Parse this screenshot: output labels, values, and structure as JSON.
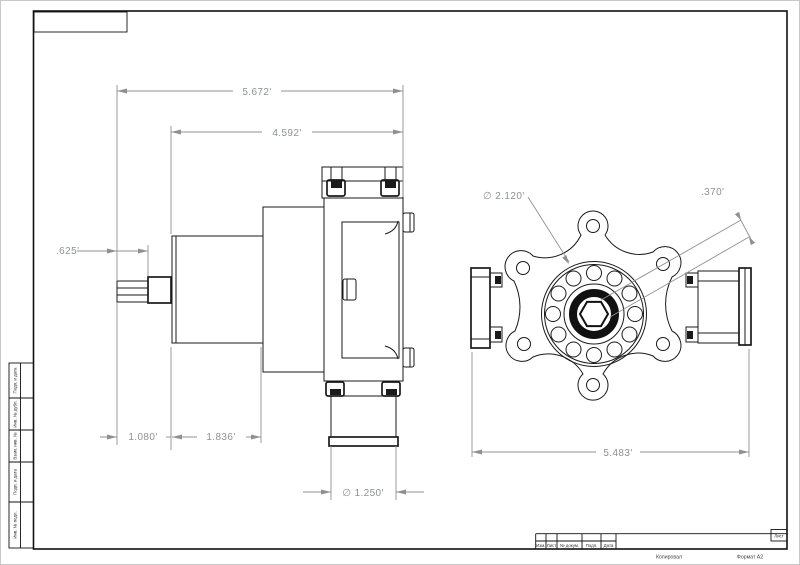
{
  "title_block": {
    "revision_headers": [
      "Изм.",
      "Лист",
      "№ докум.",
      "Подп.",
      "Дата"
    ],
    "sheet_label": "Лист",
    "copied_label": "Копировал",
    "format_label": "Формат А2"
  },
  "margin_labels": [
    "Подп. и дата",
    "Инв. № дубл.",
    "Взам. инв. №",
    "Подп. и дата",
    "Инв. № подл."
  ],
  "side_view": {
    "dim_overall": "5.672'",
    "dim_body": "4.592'",
    "dim_shaft": ".625'",
    "dim_nose": "1.080'",
    "dim_motor": "1.836'",
    "dim_outlet": "∅ 1.250'"
  },
  "front_view": {
    "dim_bore_circle": "∅ 2.120'",
    "dim_hex": ".370'",
    "dim_width": "5.483'"
  }
}
